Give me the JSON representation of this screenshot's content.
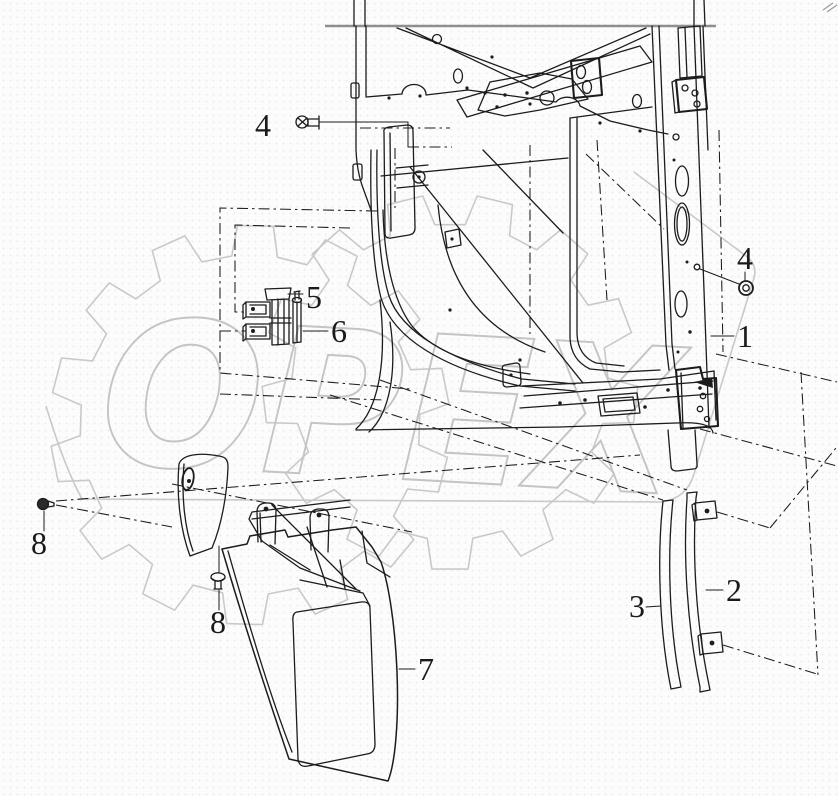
{
  "diagram": {
    "type": "exploded-parts-line-drawing",
    "subject": "Cab side frame with door hinge, step panel and glass-run rails",
    "callouts": {
      "n1": "1",
      "n2": "2",
      "n3": "3",
      "n4_top": "4",
      "n4_right": "4",
      "n5": "5",
      "n6": "6",
      "n7": "7",
      "n8_left": "8",
      "n8_mid": "8"
    },
    "watermark": {
      "text": "OPEX",
      "text_color": "#c4c4c4",
      "shape_color": "#c9c9c9"
    },
    "colors": {
      "line": "#1c1c1c",
      "frame_line": "#8f8f8f",
      "background": "#fcfcfd",
      "dot_grid": "#ebebee"
    }
  }
}
